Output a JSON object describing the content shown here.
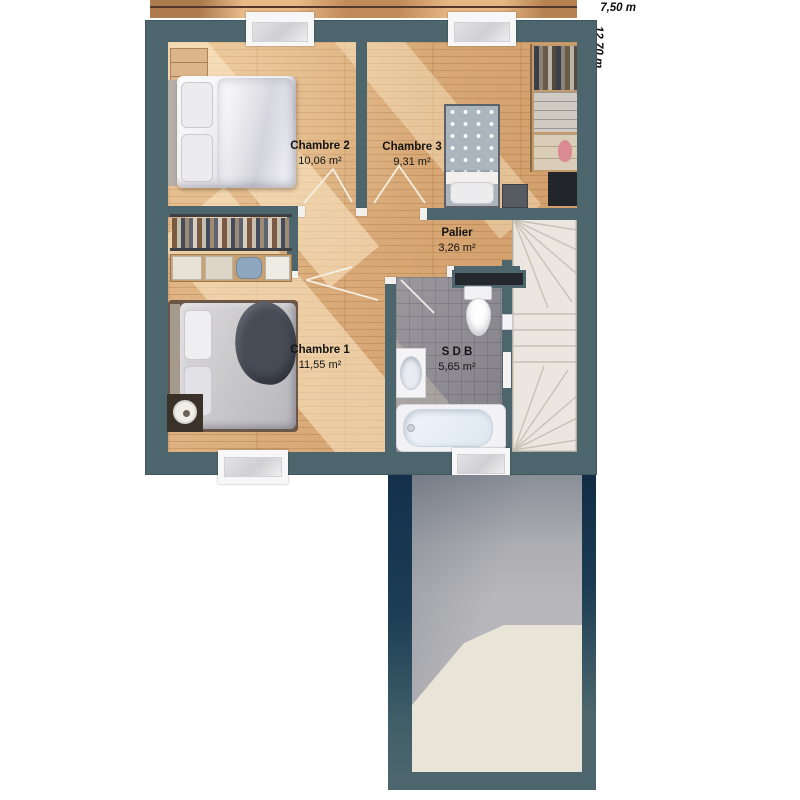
{
  "title": "Plan d'étage",
  "dimensions": {
    "width_label": "7,50 m",
    "height_label": "12,70 m"
  },
  "rooms": [
    {
      "id": "chambre2",
      "name": "Chambre 2",
      "area": "10,06 m²"
    },
    {
      "id": "chambre3",
      "name": "Chambre 3",
      "area": "9,31 m²"
    },
    {
      "id": "palier",
      "name": "Palier",
      "area": "3,26 m²"
    },
    {
      "id": "chambre1",
      "name": "Chambre 1",
      "area": "11,55 m²"
    },
    {
      "id": "sdb",
      "name": "S D B",
      "area": "5,65 m²"
    }
  ],
  "colors": {
    "wall": "#4d666d",
    "wood_floor": "#d7a571",
    "bathroom_tile": "#8f8d93",
    "stairs": "#ebe7e0",
    "concrete": "#b7b6ba",
    "shadow_navy": "#16324a",
    "sun_patch": "#e9e4d8",
    "label_text": "#141414"
  }
}
